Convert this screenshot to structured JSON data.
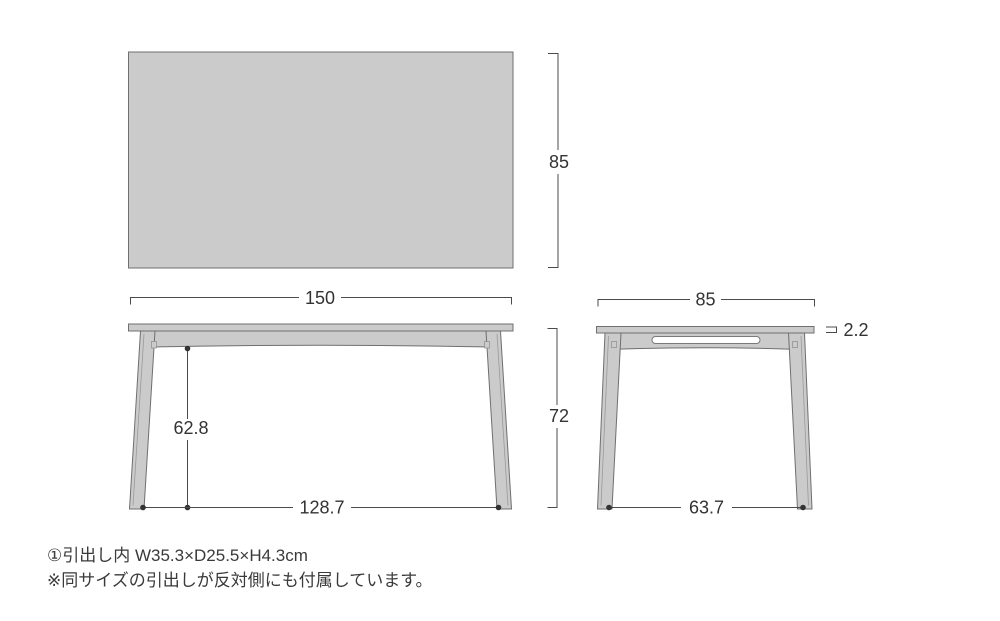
{
  "colors": {
    "background": "#ffffff",
    "table_fill": "#cbcbcb",
    "table_outline": "#6f6f6f",
    "dimension_line": "#4b4b4b",
    "label_text": "#333333"
  },
  "top_view": {
    "depth": "85"
  },
  "shared": {
    "width": "150"
  },
  "front_view": {
    "leg_inner_height": "62.8",
    "floor_span": "128.7",
    "total_height": "72"
  },
  "side_view": {
    "depth": "85",
    "top_thickness": "2.2",
    "floor_span": "63.7"
  },
  "footnotes": {
    "drawer_note": "①引出し内 W35.3×D25.5×H4.3cm",
    "opposite_note": "※同サイズの引出しが反対側にも付属しています。"
  }
}
